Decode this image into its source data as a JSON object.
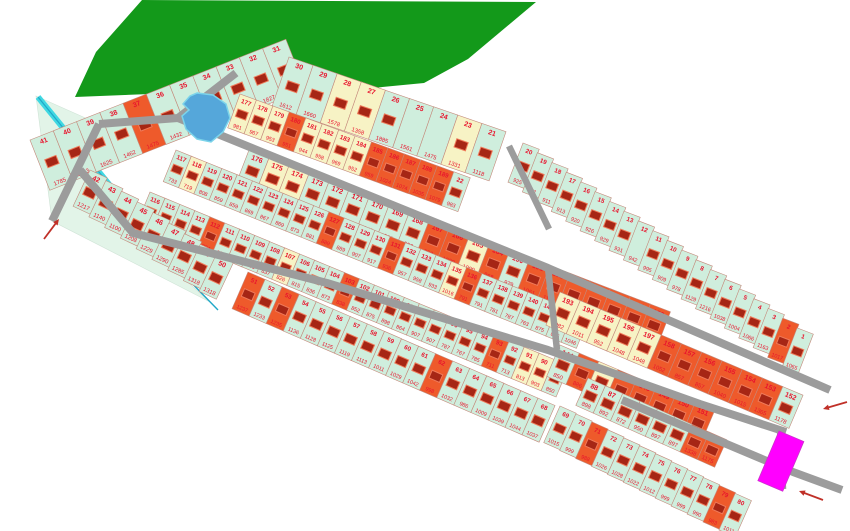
{
  "map": {
    "title": "land-plot-subdivision-plan",
    "colors": {
      "mint": "#cfeedd",
      "orange": "#ee5a2b",
      "yellow": "#f7f3c5",
      "magenta": "#ff00ff",
      "forest": "#13991a",
      "pond_fill": "#55a7da",
      "pond_edge": "#7cd4ea",
      "stream": "#40d8e2",
      "stream_core": "#1fa8c8",
      "meadow": "#e2f4e8",
      "road": "#9c9c9c",
      "lot_border": "#c4897b",
      "label_red": "#e8142d",
      "house_fill": "#a62615",
      "house_edge": "#ef7a5a",
      "arrow": "#c03028"
    },
    "forest_polygon": [
      [
        142,
        0
      ],
      [
        96,
        52
      ],
      [
        75,
        97
      ],
      [
        150,
        94
      ],
      [
        218,
        98
      ],
      [
        288,
        75
      ],
      [
        352,
        90
      ],
      [
        424,
        83
      ],
      [
        468,
        59
      ],
      [
        536,
        2
      ]
    ],
    "meadow_polygon": [
      [
        36,
        96
      ],
      [
        99,
        124
      ],
      [
        80,
        170
      ],
      [
        133,
        233
      ],
      [
        210,
        302
      ],
      [
        52,
        221
      ]
    ],
    "pond_polygon": [
      [
        197,
        93
      ],
      [
        213,
        95
      ],
      [
        226,
        104
      ],
      [
        230,
        118
      ],
      [
        223,
        132
      ],
      [
        211,
        142
      ],
      [
        197,
        139
      ],
      [
        186,
        129
      ],
      [
        182,
        116
      ],
      [
        189,
        110
      ],
      [
        183,
        104
      ],
      [
        190,
        96
      ]
    ],
    "stream": {
      "band": [
        [
          38,
          97
        ],
        [
          177,
          268
        ]
      ],
      "tail": [
        [
          177,
          268
        ],
        [
          218,
          310
        ]
      ]
    },
    "roads": [
      {
        "pts": [
          [
            52,
            221
          ],
          [
            99,
            124
          ]
        ],
        "w": 8
      },
      {
        "pts": [
          [
            236,
            73
          ],
          [
            178,
            118
          ],
          [
            99,
            124
          ]
        ],
        "w": 8
      },
      {
        "pts": [
          [
            178,
            118
          ],
          [
            548,
            268
          ],
          [
            830,
            390
          ]
        ],
        "w": 8
      },
      {
        "pts": [
          [
            509,
            146
          ],
          [
            549,
            229
          ]
        ],
        "w": 6.5
      },
      {
        "pts": [
          [
            80,
            170
          ],
          [
            133,
            233
          ],
          [
            327,
            283
          ],
          [
            548,
            350
          ],
          [
            700,
            404
          ],
          [
            786,
            432
          ]
        ],
        "w": 8
      },
      {
        "pts": [
          [
            548,
            268
          ],
          [
            557,
            350
          ]
        ],
        "w": 6.5
      },
      {
        "pts": [
          [
            780,
            430
          ],
          [
            783,
            489
          ]
        ],
        "w": 6.5
      },
      {
        "pts": [
          [
            622,
            400
          ],
          [
            793,
            472
          ],
          [
            842,
            490
          ]
        ],
        "w": 8
      }
    ],
    "arrows": [
      {
        "tail": [
          44,
          239
        ],
        "head": [
          59,
          219
        ]
      },
      {
        "tail": [
          847,
          402
        ],
        "head": [
          823,
          409
        ]
      },
      {
        "tail": [
          823,
          500
        ],
        "head": [
          799,
          491
        ]
      }
    ],
    "highlight_lot": {
      "x": 779,
      "y": 431,
      "rot": 23,
      "w": 27,
      "h": 54,
      "color": "magenta"
    },
    "strips": [
      {
        "id": "outer-nw",
        "a": [
          30,
          140
        ],
        "ba": -21.5,
        "ra": -21.5,
        "s": 25,
        "d": 54,
        "lots": [
          [
            41,
            1785
          ],
          [
            40,
            1943
          ],
          [
            39,
            1625
          ],
          [
            38,
            1462
          ],
          [
            37,
            1475,
            "o"
          ],
          [
            36,
            1432
          ],
          [
            35,
            1420
          ],
          [
            34,
            1461
          ],
          [
            33,
            1509
          ],
          [
            32,
            1827
          ],
          [
            31,
            1491
          ]
        ]
      },
      {
        "id": "outer-n",
        "a": [
          289,
          57
        ],
        "ba": 19,
        "ra": 19,
        "s": 25.5,
        "d": 52,
        "lots": [
          [
            30,
            1612
          ],
          [
            29,
            1660
          ],
          [
            28,
            1578,
            "y"
          ],
          [
            27,
            1358,
            "y"
          ],
          [
            26,
            1885
          ],
          [
            25,
            1561,
            "m",
            0
          ],
          [
            24,
            1475,
            "m",
            0
          ],
          [
            23,
            1331,
            "y"
          ],
          [
            21,
            1118
          ]
        ]
      },
      {
        "id": "outer-ne",
        "a": [
          523,
          143
        ],
        "ba": 34,
        "ra": 21,
        "s": 17.4,
        "d": 42,
        "lots": [
          [
            20,
            925
          ],
          [
            19,
            851
          ],
          [
            18,
            911
          ],
          [
            17,
            913
          ],
          [
            16,
            920
          ],
          [
            15,
            926
          ],
          [
            14,
            929
          ],
          [
            13,
            931
          ],
          [
            12,
            942,
            "m",
            0
          ],
          [
            11,
            995
          ],
          [
            10,
            909
          ],
          [
            9,
            978
          ],
          [
            8,
            1129
          ],
          [
            7,
            1216
          ],
          [
            6,
            1038
          ],
          [
            5,
            1004
          ],
          [
            4,
            1066
          ],
          [
            3,
            1163
          ],
          [
            2,
            1017,
            "o"
          ],
          [
            1,
            1065
          ]
        ]
      },
      {
        "id": "row-b1",
        "a": [
          240,
          94
        ],
        "ba": 20,
        "ra": 20,
        "s": 17.5,
        "d": 36,
        "lots": [
          [
            177,
            981,
            "y"
          ],
          [
            178,
            967,
            "y"
          ],
          [
            179,
            953,
            "y"
          ],
          [
            180,
            951,
            "o"
          ],
          [
            181,
            944,
            "y"
          ],
          [
            182,
            958,
            "y"
          ],
          [
            183,
            969,
            "y"
          ],
          [
            184,
            952,
            "y"
          ],
          [
            185,
            959,
            "o"
          ],
          [
            186,
            1024,
            "o"
          ],
          [
            187,
            1074,
            "o"
          ],
          [
            188,
            1035,
            "o"
          ],
          [
            189,
            1079,
            "o"
          ],
          [
            22,
            983
          ]
        ]
      },
      {
        "id": "row-b2",
        "a": [
          249,
          150
        ],
        "ba": 21,
        "ra": 21,
        "s": 21.5,
        "d": 36,
        "lots": [
          [
            176,
            969
          ],
          [
            175,
            955,
            "y"
          ],
          [
            174,
            948,
            "y"
          ],
          [
            173,
            948
          ],
          [
            172,
            943
          ],
          [
            171,
            965
          ],
          [
            170,
            949
          ],
          [
            169,
            961
          ],
          [
            168,
            953
          ],
          [
            167,
            950,
            "o"
          ],
          [
            166,
            1030,
            "o"
          ],
          [
            165,
            1009,
            "y"
          ],
          [
            164,
            968,
            "o"
          ],
          [
            190,
            979
          ],
          [
            191,
            1061,
            "o"
          ],
          [
            192,
            1153,
            "o"
          ],
          [
            163,
            977,
            "o"
          ],
          [
            162,
            911,
            "o"
          ],
          [
            161,
            1151,
            "o"
          ],
          [
            160,
            1062,
            "o"
          ],
          [
            159,
            1052,
            "o"
          ]
        ]
      },
      {
        "id": "row-c1",
        "a": [
          176,
          150
        ],
        "ba": 22,
        "ra": 22,
        "s": 16.5,
        "d": 34,
        "lots": [
          [
            117,
            733
          ],
          [
            118,
            719,
            "y"
          ],
          [
            119,
            808
          ],
          [
            120,
            859
          ],
          [
            121,
            859
          ],
          [
            122,
            869
          ],
          [
            123,
            867
          ],
          [
            124,
            869
          ],
          [
            125,
            873
          ],
          [
            126,
            881
          ],
          [
            127,
            889,
            "o"
          ],
          [
            128,
            889
          ],
          [
            129,
            907
          ],
          [
            130,
            917
          ],
          [
            131,
            936,
            "o"
          ],
          [
            132,
            957
          ],
          [
            133,
            958
          ],
          [
            134,
            933
          ],
          [
            135,
            1016,
            "y"
          ],
          [
            136,
            791,
            "o"
          ],
          [
            137,
            791
          ],
          [
            138,
            781
          ],
          [
            139,
            787
          ],
          [
            140,
            763
          ],
          [
            141,
            875
          ],
          [
            142,
            875
          ],
          [
            143,
            1046
          ]
        ]
      },
      {
        "id": "row-c2",
        "a": [
          150,
          192
        ],
        "ba": 22.5,
        "ra": 22.5,
        "s": 16.2,
        "d": 34,
        "lots": [
          [
            116,
            820
          ],
          [
            115,
            825
          ],
          [
            114,
            986
          ],
          [
            113,
            965
          ],
          [
            112,
            934,
            "o"
          ],
          [
            111,
            952
          ],
          [
            110,
            873
          ],
          [
            109,
            831
          ],
          [
            108,
            837
          ],
          [
            107,
            826,
            "y"
          ],
          [
            106,
            815
          ],
          [
            105,
            836
          ],
          [
            104,
            873
          ],
          [
            103,
            838,
            "o"
          ],
          [
            102,
            852
          ],
          [
            101,
            875
          ],
          [
            100,
            898
          ],
          [
            99,
            864
          ],
          [
            98,
            907
          ],
          [
            97,
            907
          ],
          [
            96,
            787
          ],
          [
            95,
            767
          ],
          [
            94,
            785
          ],
          [
            93,
            711,
            "o"
          ],
          [
            92,
            713
          ],
          [
            91,
            813,
            "y"
          ],
          [
            90,
            903,
            "y"
          ],
          [
            89,
            850
          ]
        ]
      },
      {
        "id": "row-d1",
        "a": [
          560,
          292
        ],
        "ba": 23,
        "ra": 23,
        "s": 22,
        "d": 36,
        "lots": [
          [
            193,
            1082,
            "y"
          ],
          [
            194,
            1011,
            "y"
          ],
          [
            195,
            952,
            "y"
          ],
          [
            196,
            1048,
            "y"
          ],
          [
            197,
            1048,
            "y"
          ],
          [
            158,
            1052,
            "o"
          ],
          [
            157,
            857,
            "o"
          ],
          [
            156,
            857,
            "o"
          ],
          [
            155,
            1040,
            "o"
          ],
          [
            154,
            1015,
            "o"
          ],
          [
            153,
            1365,
            "o"
          ],
          [
            152,
            1178
          ]
        ]
      },
      {
        "id": "row-d2",
        "a": [
          560,
          345
        ],
        "ba": 23,
        "ra": 23,
        "s": 21,
        "d": 34,
        "lots": [
          [
            144,
            850
          ],
          [
            145,
            886,
            "o"
          ],
          [
            146,
            865,
            "y"
          ],
          [
            147,
            887,
            "o"
          ],
          [
            148,
            898,
            "o"
          ],
          [
            149,
            940,
            "o"
          ],
          [
            150,
            1245,
            "o"
          ],
          [
            151,
            1248,
            "o"
          ]
        ]
      },
      {
        "id": "row-d3",
        "a": [
          588,
          378
        ],
        "ba": 24,
        "ra": 24,
        "s": 19,
        "d": 30,
        "lots": [
          [
            88,
            898
          ],
          [
            87,
            892
          ],
          [
            86,
            872
          ],
          [
            85,
            950
          ],
          [
            84,
            897
          ],
          [
            83,
            897
          ],
          [
            82,
            1338,
            "o"
          ],
          [
            81,
            1175,
            "o"
          ]
        ]
      },
      {
        "id": "edge-s1",
        "a": [
          90,
          170
        ],
        "ba": 34,
        "ra": 25,
        "s": 19,
        "d": 40,
        "lots": [
          [
            42,
            1217
          ],
          [
            43,
            1140
          ],
          [
            44,
            1100
          ],
          [
            45,
            1208
          ],
          [
            46,
            1229
          ],
          [
            47,
            1290
          ],
          [
            48,
            1285
          ],
          [
            49,
            1318
          ],
          [
            50,
            1318
          ]
        ]
      },
      {
        "id": "edge-s2",
        "a": [
          248,
          272
        ],
        "ba": 23.5,
        "ra": 23.5,
        "s": 18.6,
        "d": 40,
        "lots": [
          [
            51,
            1237,
            "o"
          ],
          [
            52,
            1233
          ],
          [
            53,
            1235,
            "o"
          ],
          [
            54,
            1136
          ],
          [
            55,
            1128
          ],
          [
            56,
            1125
          ],
          [
            57,
            1119
          ],
          [
            58,
            1113
          ],
          [
            59,
            1011
          ],
          [
            60,
            1029
          ],
          [
            61,
            1042
          ],
          [
            62,
            998,
            "o"
          ],
          [
            63,
            1032
          ],
          [
            64,
            986
          ],
          [
            65,
            1009
          ],
          [
            66,
            1039
          ],
          [
            67,
            1044
          ],
          [
            68,
            1037
          ]
        ]
      },
      {
        "id": "edge-s3",
        "a": [
          560,
          406
        ],
        "ba": 26.5,
        "ra": 24,
        "s": 17.8,
        "d": 40,
        "lots": [
          [
            69,
            1015
          ],
          [
            70,
            999
          ],
          [
            71,
            988,
            "o"
          ],
          [
            72,
            1026
          ],
          [
            73,
            1028
          ],
          [
            74,
            1022
          ],
          [
            75,
            1012
          ],
          [
            76,
            999
          ],
          [
            77,
            999
          ],
          [
            78,
            990
          ],
          [
            79,
            983,
            "o"
          ],
          [
            80,
            1011
          ]
        ]
      }
    ]
  }
}
